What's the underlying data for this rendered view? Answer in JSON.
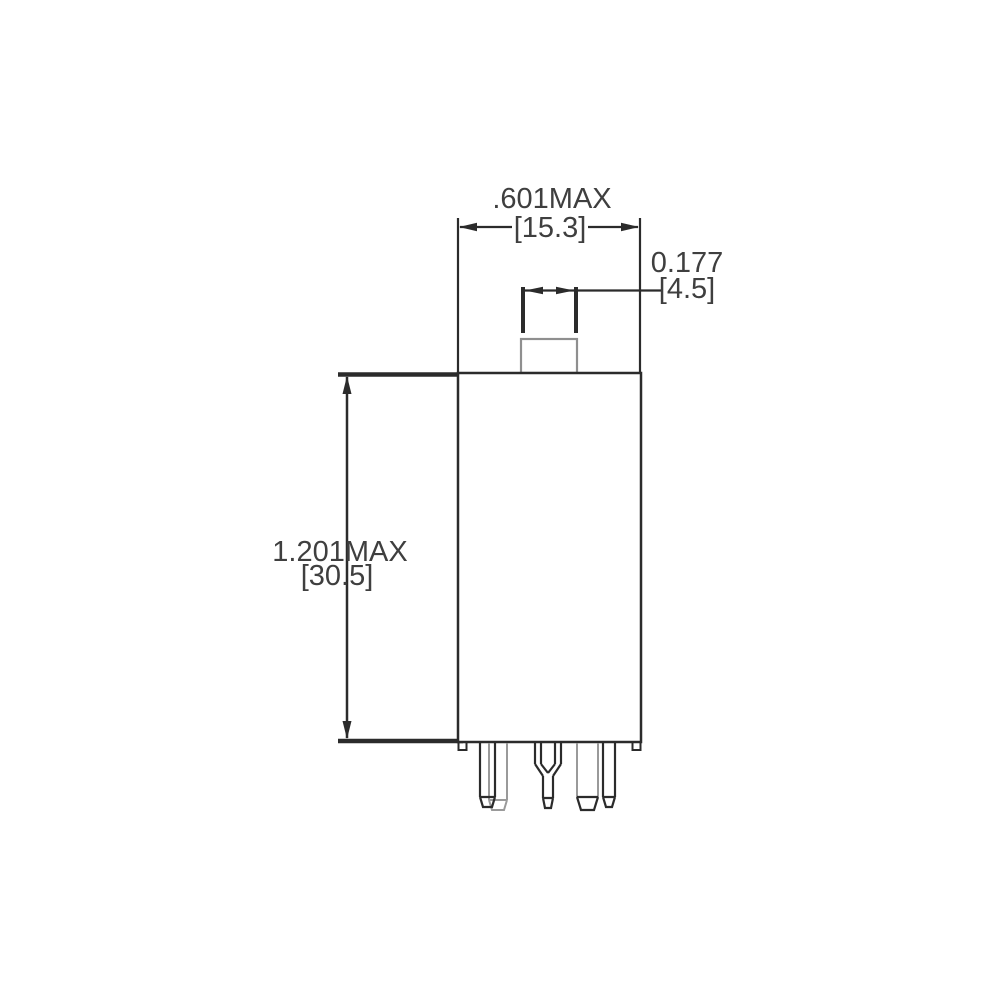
{
  "dimensions": {
    "width": {
      "imperial": ".601MAX",
      "metric": "[15.3]"
    },
    "tab_width": {
      "imperial": "0.177",
      "metric": "[4.5]"
    },
    "height": {
      "imperial": "1.201MAX",
      "metric": "[30.5]"
    }
  },
  "colors": {
    "line": "#2b2b2b",
    "secondary_line": "#9a9a9a",
    "text": "#3f3f3f",
    "background": "#ffffff"
  }
}
